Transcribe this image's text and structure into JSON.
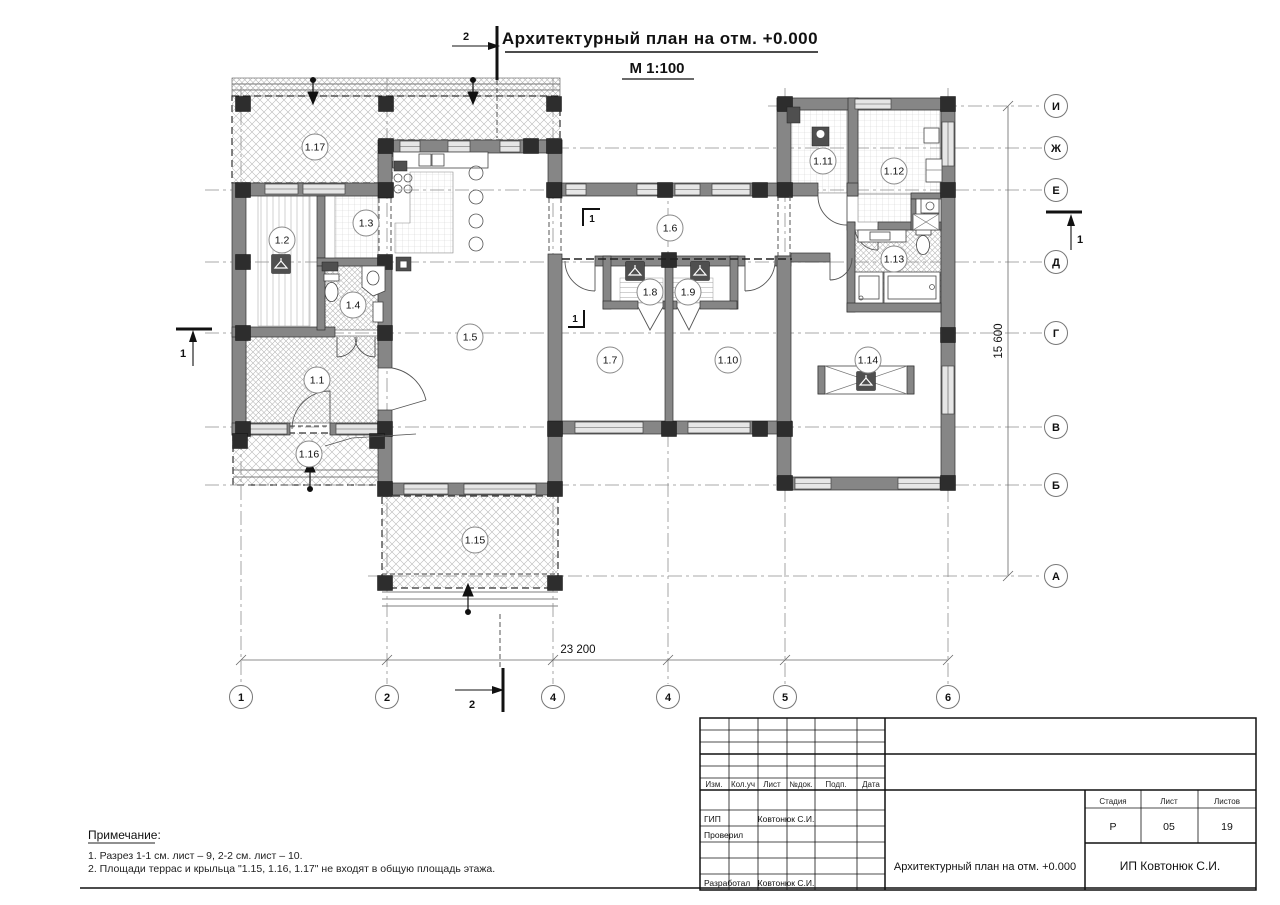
{
  "title": {
    "main": "Архитектурный план на отм. +0.000",
    "scale": "М 1:100"
  },
  "sections": {
    "s1": "1",
    "s2": "2"
  },
  "dimensions": {
    "width": "23 200",
    "height": "15 600"
  },
  "axes": {
    "horizontal": [
      {
        "label": "И",
        "y": 106
      },
      {
        "label": "Ж",
        "y": 148
      },
      {
        "label": "Е",
        "y": 190
      },
      {
        "label": "Д",
        "y": 262
      },
      {
        "label": "Г",
        "y": 333
      },
      {
        "label": "В",
        "y": 427
      },
      {
        "label": "Б",
        "y": 485
      },
      {
        "label": "А",
        "y": 576
      }
    ],
    "vertical": [
      {
        "label": "1",
        "x": 241
      },
      {
        "label": "2",
        "x": 387
      },
      {
        "label": "4",
        "x": 553
      },
      {
        "label": "4",
        "x": 668
      },
      {
        "label": "5",
        "x": 785
      },
      {
        "label": "6",
        "x": 948
      }
    ]
  },
  "rooms": [
    {
      "id": "1.1",
      "x": 317,
      "y": 380
    },
    {
      "id": "1.2",
      "x": 282,
      "y": 240
    },
    {
      "id": "1.3",
      "x": 366,
      "y": 223
    },
    {
      "id": "1.4",
      "x": 353,
      "y": 305
    },
    {
      "id": "1.5",
      "x": 470,
      "y": 337
    },
    {
      "id": "1.6",
      "x": 670,
      "y": 228
    },
    {
      "id": "1.7",
      "x": 610,
      "y": 360
    },
    {
      "id": "1.8",
      "x": 650,
      "y": 292
    },
    {
      "id": "1.9",
      "x": 688,
      "y": 292
    },
    {
      "id": "1.10",
      "x": 728,
      "y": 360
    },
    {
      "id": "1.11",
      "x": 823,
      "y": 161
    },
    {
      "id": "1.12",
      "x": 894,
      "y": 171
    },
    {
      "id": "1.13",
      "x": 894,
      "y": 259
    },
    {
      "id": "1.14",
      "x": 868,
      "y": 360
    },
    {
      "id": "1.15",
      "x": 475,
      "y": 540
    },
    {
      "id": "1.16",
      "x": 309,
      "y": 454
    },
    {
      "id": "1.17",
      "x": 315,
      "y": 147
    }
  ],
  "notes": {
    "heading": "Примечание:",
    "items": [
      "1. Разрез 1-1 см. лист – 9, 2-2 см. лист – 10.",
      "2. Площади террас и крыльца \"1.15, 1.16, 1.17\" не входят в общую площадь этажа."
    ]
  },
  "titleblock": {
    "header_cols": [
      "Изм.",
      "Кол.уч",
      "Лист",
      "№док.",
      "Подп.",
      "Дата"
    ],
    "rows": [
      {
        "role": "ГИП",
        "name": "Ковтонюк С.И."
      },
      {
        "role": "Проверил",
        "name": ""
      },
      {
        "role": "Разработал",
        "name": "Ковтонюк С.И."
      }
    ],
    "stage_label": "Стадия",
    "sheet_label": "Лист",
    "sheets_label": "Листов",
    "stage": "Р",
    "sheet": "05",
    "sheets": "19",
    "doc_title": "Архитектурный план на отм. +0.000",
    "company": "ИП Ковтонюк С.И."
  }
}
